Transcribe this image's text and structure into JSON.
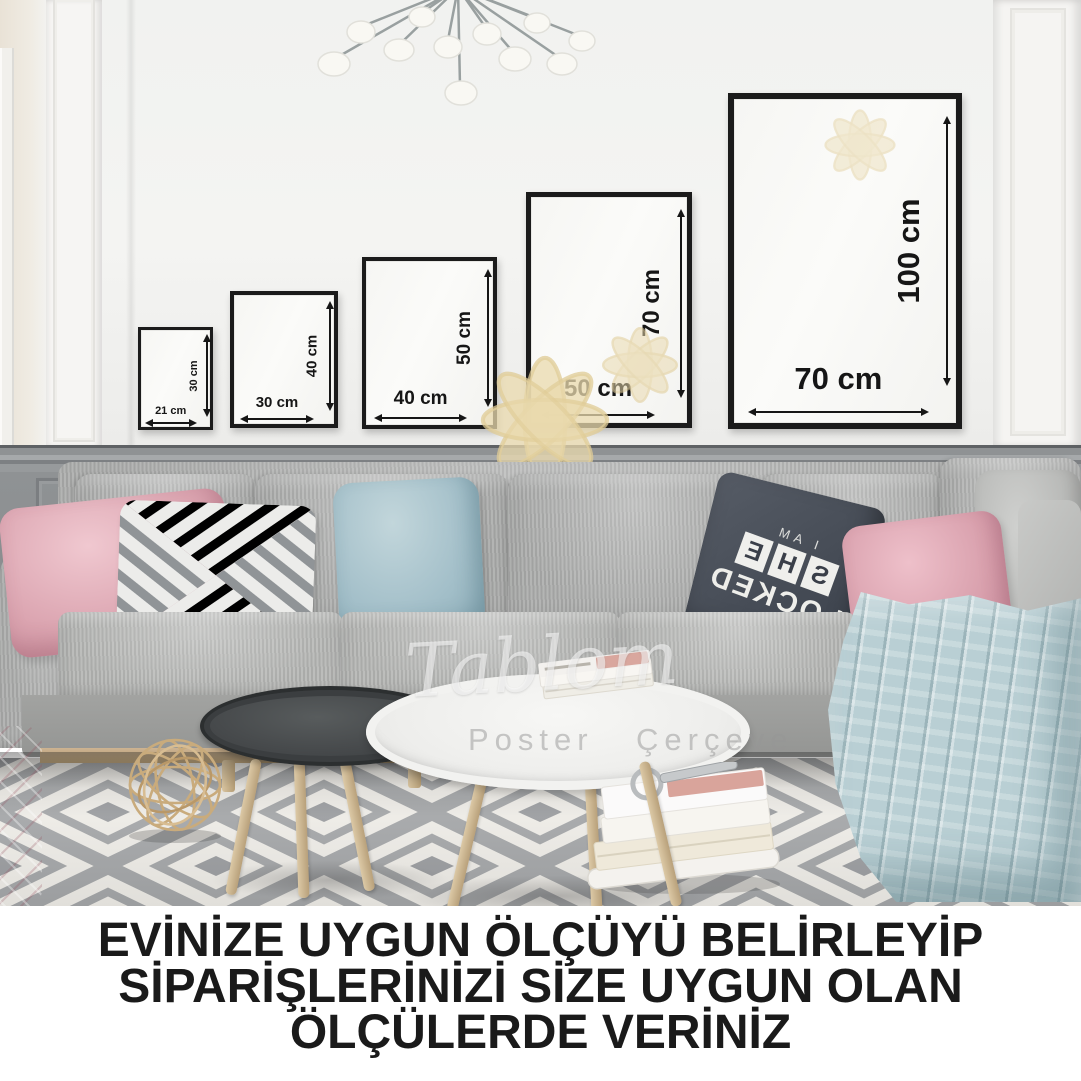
{
  "frames": [
    {
      "width_label": "21 cm",
      "height_label": "30 cm"
    },
    {
      "width_label": "30 cm",
      "height_label": "40 cm"
    },
    {
      "width_label": "40 cm",
      "height_label": "50 cm"
    },
    {
      "width_label": "50 cm",
      "height_label": "70 cm"
    },
    {
      "width_label": "70 cm",
      "height_label": "100 cm"
    }
  ],
  "caption": {
    "line1": "EVİNİZE UYGUN ÖLÇÜYÜ BELİRLEYİP",
    "line2": "SİPARİŞLERİNİZİ SİZE UYGUN OLAN",
    "line3": "ÖLÇÜLERDE VERİNİZ"
  },
  "pillow_text": {
    "line1": "I AM",
    "letters": [
      "S",
      "H",
      "E"
    ],
    "line3": "LOCKED"
  },
  "watermark": {
    "script": "Tablom",
    "word1": "Poster",
    "word2": "Çerçeve"
  },
  "colors": {
    "frame_border": "#1b1b1b",
    "caption_text": "#1a1a1a",
    "wall_white": "#f3f3f1",
    "wainscot_gray": "#8d9092",
    "sofa_gray": "#aaabaa",
    "pillow_pink": "#dba4b0",
    "pillow_blue": "#a3bfc9",
    "blanket_blue": "#b9cfd4",
    "wood": "#c4ab84"
  }
}
